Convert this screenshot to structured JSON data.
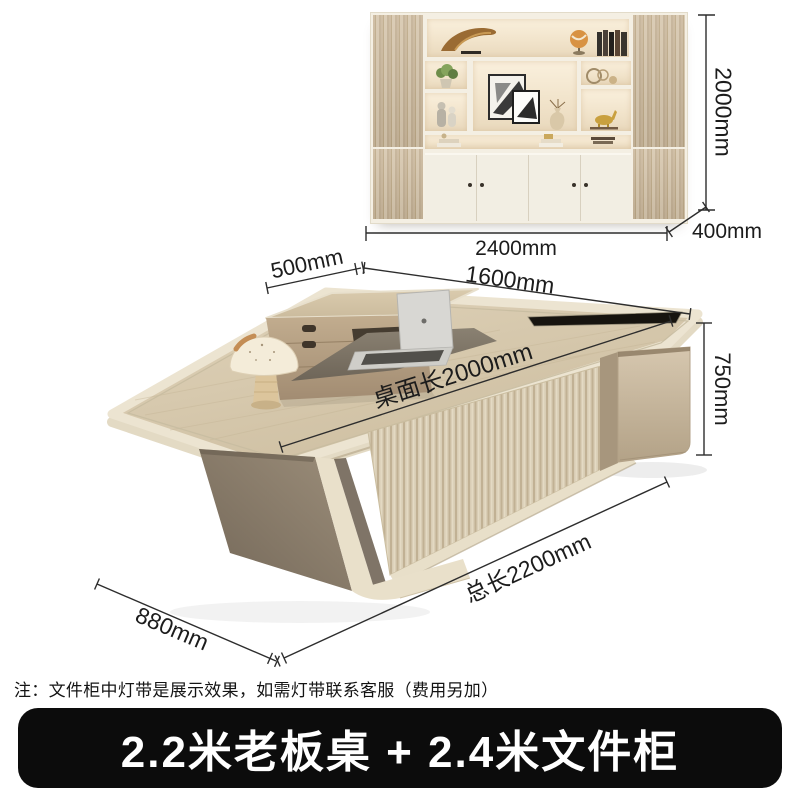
{
  "annotations": {
    "cabinet_height": "2000mm",
    "cabinet_width": "2400mm",
    "cabinet_depth": "400mm",
    "return_depth": "500mm",
    "desk_width": "1600mm",
    "desktop_length": "桌面长2000mm",
    "desk_height": "750mm",
    "total_length": "总长2200mm",
    "desk_depth": "880mm"
  },
  "note": "注：文件柜中灯带是展示效果，如需灯带联系客服（费用另加）",
  "banner": {
    "label": "2.2米老板桌 + 2.4米文件柜",
    "bg": "#0c0c0c",
    "text_color": "#ffffff"
  },
  "colors": {
    "desk_wood": "#d5c7ab",
    "edge_trim": "#ece4d1",
    "leg_taupe": "#8a7c6b",
    "flute_panel": "#d8cbb2",
    "cabinet_glow": "#f7ead5",
    "dimension_line": "#2d2d2d"
  }
}
